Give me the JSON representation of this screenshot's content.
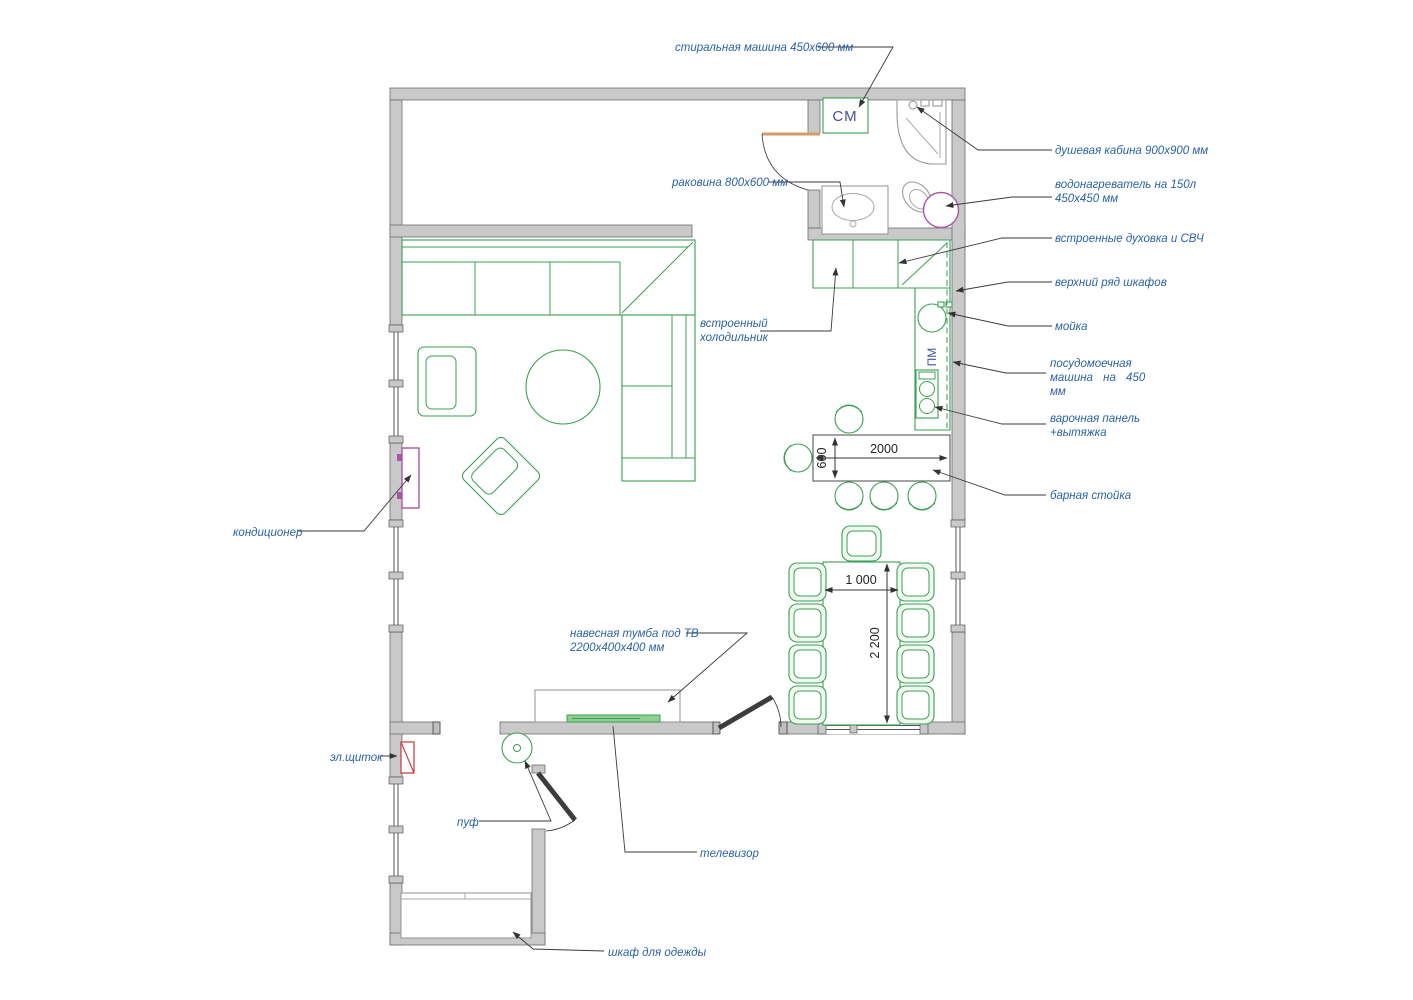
{
  "colors": {
    "wall_gray": "#c9c9c9",
    "furniture_green": "#3aa053",
    "label_blue": "#2b62a8",
    "marker_indigo": "#4350a8",
    "ac_purple": "#a855a8",
    "panel_red": "#cc4444",
    "door_orange": "#d49a6a",
    "dimension_dark": "#333333"
  },
  "labels": {
    "washing_machine": "стиральная машина 450х600 мм",
    "shower": "душевая кабина 900х900 мм",
    "water_heater_line1": "водонагреватель на 150л",
    "water_heater_line2": "450х450 мм",
    "bath_sink": "раковина 800х600 мм",
    "oven_micro": "встроенные духовка и СВЧ",
    "upper_cabinets": "верхний ряд шкафов",
    "kitchen_sink": "мойка",
    "dishwasher_line1": "посудомоечная",
    "dishwasher_line2": "машина на 450",
    "dishwasher_line3": "мм",
    "cooktop_line1": "варочная панель",
    "cooktop_line2": "+вытяжка",
    "bar_counter": "барная стойка",
    "fridge_line1": "встроенный",
    "fridge_line2": "холодильник",
    "air_conditioner": "кондиционер",
    "electric_panel": "эл.щиток",
    "pouf": "пуф",
    "tv_cabinet_line1": "навесная тумба под ТВ",
    "tv_cabinet_line2": "2200х400х400 мм",
    "tv": "телевизор",
    "wardrobe": "шкаф для одежды"
  },
  "markers": {
    "washing_machine": "СМ",
    "dishwasher": "ПМ"
  },
  "dimensions": {
    "bar_length": "2000",
    "bar_depth": "600",
    "table_width": "1 000",
    "table_length": "2 200"
  }
}
